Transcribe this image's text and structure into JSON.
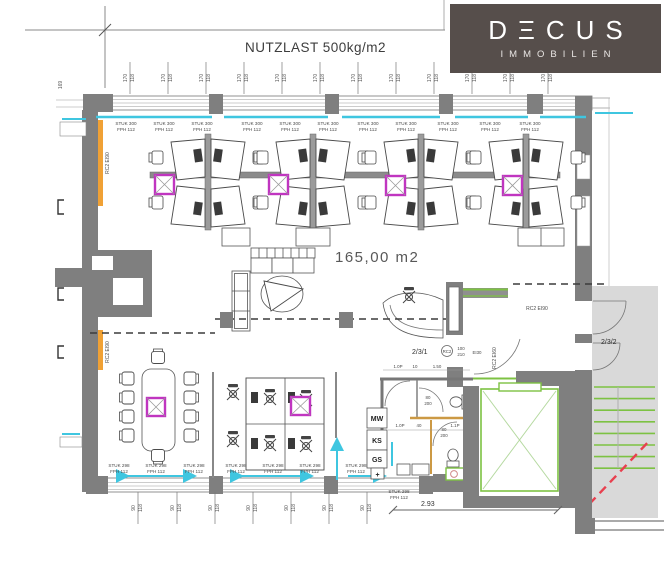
{
  "logo": {
    "brand": "DECUS",
    "brand_display": "DΞCUS",
    "subtitle": "IMMOBILIEN",
    "bg_color": "#564e4b"
  },
  "title": "NUTZLAST 500kg/m2",
  "area": "165,00 m2",
  "rooms": {
    "r1": "2/3/1",
    "r2": "2/3/2"
  },
  "badges": {
    "rc2": "RC2"
  },
  "fire_labels": {
    "wall90": "RC2 EI90",
    "wall60": "RC2 EI60",
    "door": "EI30"
  },
  "wall_labels": {
    "stuk300": "STUK 300",
    "stuk298": "STUK 298",
    "fph112": "FPH 112"
  },
  "kitchen": {
    "mw": "MW",
    "ks": "KS",
    "gs": "GS",
    "plus": "+"
  },
  "dims": {
    "top_a": "170",
    "top_b": "118",
    "bot_a": "90",
    "bot_b": "118",
    "left_v": "169",
    "door_w": "100",
    "door_h": "210",
    "wc_w": "80",
    "wc_h": "200",
    "p10": "1.0P",
    "n10": "10",
    "n150": "1.50",
    "n40": "40",
    "p11": "1.1P",
    "total": "2.93"
  },
  "colors": {
    "wall": "#7f7f7f",
    "cyan": "#3fc6e0",
    "magenta": "#c035c0",
    "orange": "#f0a135",
    "green": "#7dc243",
    "red": "#e8404f",
    "stair_bg": "#d9d9d9",
    "logo_bg": "#564e4b"
  }
}
